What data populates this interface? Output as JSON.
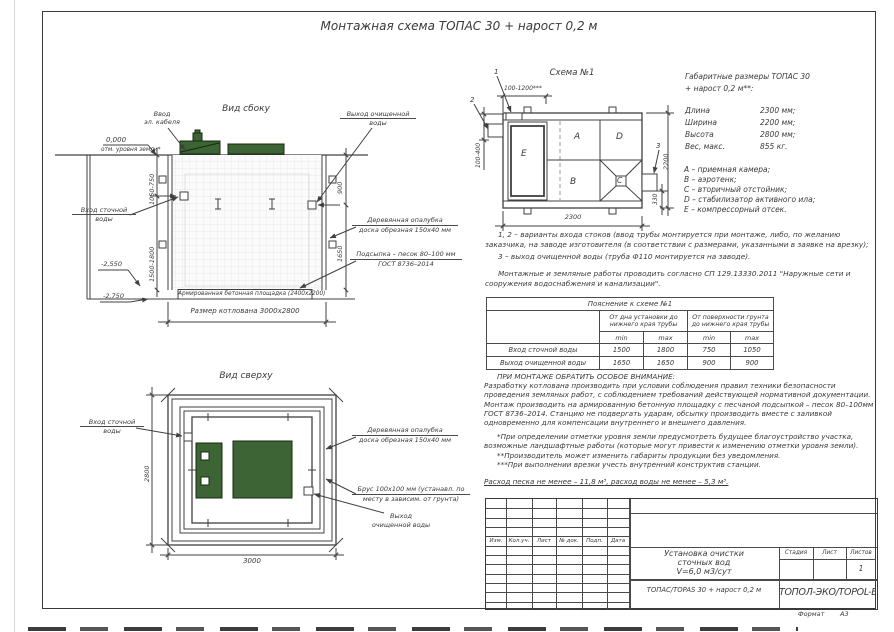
{
  "sheet": {
    "title": "Монтажная схема ТОПАС 30 + нарост 0,2 м",
    "format_label": "Формат",
    "format_value": "А3"
  },
  "side_view": {
    "title": "Вид сбоку",
    "ground_mark": "0,000",
    "ground_mark_note": "отм. уровня земли*",
    "cable_entry_l1": "Ввод",
    "cable_entry_l2": "эл. кабеля",
    "inlet_l1": "Вход сточной",
    "inlet_l2": "воды",
    "outlet_l1": "Выход очищенной",
    "outlet_l2": "воды",
    "formwork_l1": "Деревянная опалубка",
    "formwork_l2": "доска обрезная 150х40 мм",
    "bedding_l1": "Подсыпка – песок 80–100 мм",
    "bedding_l2": "ГОСТ 8736–2014",
    "slab_label": "Армированная бетонная площадка (2400х2200)",
    "pit_size": "Размер котлована 3000х2800",
    "dim_top_left": "1050-750",
    "dim_bottom_left": "1500-1800",
    "dim_top_right": "900",
    "dim_bottom_right": "1650",
    "level_slab": "-2,550",
    "level_bottom": "-2,750"
  },
  "top_view": {
    "title": "Вид сверху",
    "inlet_l1": "Вход сточной",
    "inlet_l2": "воды",
    "formwork_l1": "Деревянная опалубка",
    "formwork_l2": "доска обрезная 150х40 мм",
    "beam_l1": "Брус 100х100 мм (устанавл. по",
    "beam_l2": "месту в зависим. от грунта)",
    "outlet_l1": "Выход",
    "outlet_l2": "очищенной воды",
    "dim_height": "2800",
    "dim_width": "3000"
  },
  "scheme": {
    "title": "Схема №1",
    "marker1": "1",
    "marker2": "2",
    "marker3": "3",
    "dim_inlet_range": "100-1200***",
    "dim_inlet_depth": "100-400",
    "dim_outlet": "330",
    "dim_length": "2300",
    "dim_width": "2200",
    "compartments": {
      "a": "A",
      "b": "B",
      "c": "C",
      "d": "D",
      "e": "E"
    }
  },
  "specs": {
    "title_l1": "Габаритные размеры ТОПАС 30",
    "title_l2": "+ нарост 0,2 м**:",
    "rows": [
      {
        "label": "Длина",
        "value": "2300 мм;"
      },
      {
        "label": "Ширина",
        "value": "2200 мм;"
      },
      {
        "label": "Высота",
        "value": "2800 мм;"
      },
      {
        "label": "Вес, макс.",
        "value": "855 кг."
      }
    ],
    "legend": [
      "A – приемная камера;",
      "B – аэротенк;",
      "C – вторичный отстойник;",
      "D – стабилизатор активного ила;",
      "E – компрессорный отсек."
    ]
  },
  "notes": {
    "n1": "1, 2 – варианты входа стоков (ввод трубы монтируется при монтаже, либо, по желанию заказчика, на заводе изготовителя (в соответствии с размерами, указанными в заявке на врезку);",
    "n2": "3 – выход очищенной воды (труба Ф110 монтируется на заводе).",
    "n3": "Монтажные и земляные работы проводить согласно СП 129.13330.2011 \"Наружные сети и сооружения водоснабжения и канализации\"."
  },
  "table": {
    "title": "Пояснение к схеме №1",
    "group1": "От дна установки до нижнего края трубы",
    "group2": "От поверхности грунта до нижнего края трубы",
    "min": "min",
    "max": "max",
    "rows": [
      {
        "label": "Вход сточной воды",
        "v1": "1500",
        "v2": "1800",
        "v3": "750",
        "v4": "1050"
      },
      {
        "label": "Выход очищенной воды",
        "v1": "1650",
        "v2": "1650",
        "v3": "900",
        "v4": "900"
      }
    ]
  },
  "attention": {
    "heading": "ПРИ МОНТАЖЕ ОБРАТИТЬ ОСОБОЕ ВНИМАНИЕ:",
    "body": "Разработку котлована производить при условии соблюдения правил техники безопасности проведения земляных работ, с соблюдением требований действующей нормативной документации.  Монтаж производить на армированную бетонную площадку с песчаной подсыпкой – песок 80–100мм ГОСТ 8736–2014. Станцию не подвергать ударам, обсыпку производить вместе с заливкой одновременно для компенсации внутреннего и внешнего давления.",
    "fn1": "*При определении отметки уровня земли предусмотреть будущее благоустройство участка, возможные ландшафтные работы (которые могут привести к изменению отметки уровня земли).",
    "fn2": "**Производитель может изменить габариты продукции без уведомления.",
    "fn3": "***При выполнении врезки учесть внутренний конструктив станции.",
    "consumption": "Расход песка не менее – 11,8 м³, расход воды не менее – 5,3 м³."
  },
  "title_block": {
    "rev_headers": [
      "Изм.",
      "Кол.уч.",
      "Лист",
      "№ док.",
      "Подп.",
      "Дата"
    ],
    "doc_l1": "Установка очистки",
    "doc_l2": "сточных вод",
    "doc_l3": "V=6,0 м3/сут",
    "stage_label": "Стадия",
    "sheet_label": "Лист",
    "sheets_label": "Листов",
    "sheets_value": "1",
    "product": "ТОПАС/TOPAS 30 + нарост 0,2 м",
    "company": "ТОПОЛ-ЭКО/TOPOL-ECO"
  },
  "colors": {
    "line": "#404040",
    "green": "#3c6434",
    "green_dark": "#17280f"
  }
}
